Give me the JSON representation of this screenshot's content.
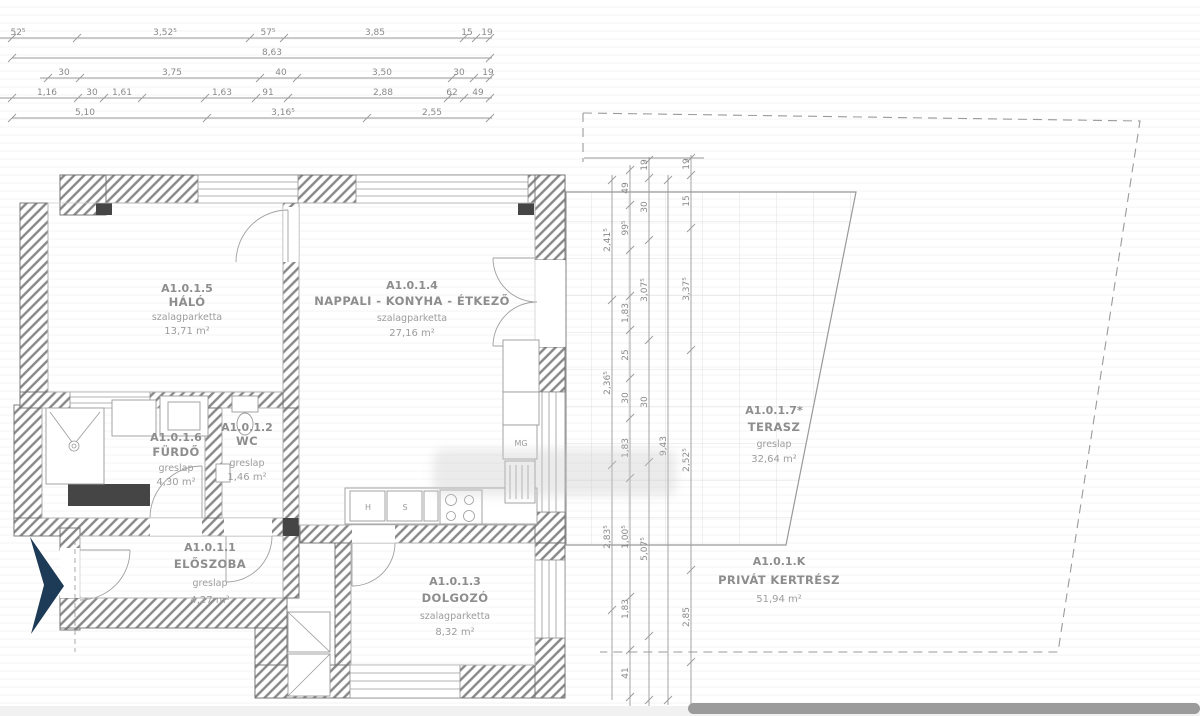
{
  "rooms": [
    {
      "id": "A1.0.1.5",
      "name": "HÁLÓ",
      "finish": "szalagparketta",
      "area": "13,71 m²"
    },
    {
      "id": "A1.0.1.4",
      "name": "NAPPALI - KONYHA - ÉTKEZŐ",
      "finish": "szalagparketta",
      "area": "27,16 m²"
    },
    {
      "id": "A1.0.1.6",
      "name": "FÜRDŐ",
      "finish": "greslap",
      "area": "4,30 m²"
    },
    {
      "id": "A1.0.1.2",
      "name": "WC",
      "finish": "greslap",
      "area": "1,46 m²"
    },
    {
      "id": "A1.0.1.1",
      "name": "ELŐSZOBA",
      "finish": "greslap",
      "area": "4,27 m²"
    },
    {
      "id": "A1.0.1.3",
      "name": "DOLGOZÓ",
      "finish": "szalagparketta",
      "area": "8,32 m²"
    },
    {
      "id": "A1.0.1.7*",
      "name": "TERASZ",
      "finish": "greslap",
      "area": "32,64 m²"
    },
    {
      "id": "A1.0.1.K",
      "name": "PRIVÁT KERTRÉSZ",
      "finish": "",
      "area": "51,94 m²"
    }
  ],
  "kitchen": {
    "h": "H",
    "s": "S",
    "mg": "MG"
  },
  "colors": {
    "arrow": "#1d3a57",
    "wall_hatch": "#878787",
    "dim_text": "#8a8a8a"
  },
  "dimensions": {
    "top_labels": [
      [
        "52⁵",
        18,
        35
      ],
      [
        "3,52⁵",
        165,
        35
      ],
      [
        "57⁵",
        268,
        35
      ],
      [
        "3,85",
        375,
        35
      ],
      [
        "15",
        467,
        35
      ],
      [
        "19",
        487,
        35
      ],
      [
        "8,63",
        272,
        55
      ],
      [
        "30",
        64,
        75
      ],
      [
        "3,75",
        172,
        75
      ],
      [
        "40",
        281,
        75
      ],
      [
        "3,50",
        382,
        75
      ],
      [
        "30",
        459,
        75
      ],
      [
        "19",
        488,
        75
      ],
      [
        "1,16",
        47,
        95
      ],
      [
        "30",
        92,
        95
      ],
      [
        "1,61",
        122,
        95
      ],
      [
        "1,63",
        222,
        95
      ],
      [
        "91",
        268,
        95
      ],
      [
        "2,88",
        383,
        95
      ],
      [
        "62",
        452,
        95
      ],
      [
        "49",
        478,
        95
      ],
      [
        "5,10",
        85,
        115
      ],
      [
        "3,16⁵",
        283,
        115
      ],
      [
        "2,55",
        432,
        115
      ]
    ],
    "top_lines": [
      [
        38,
        0,
        492
      ],
      [
        58,
        12,
        492
      ],
      [
        78,
        40,
        492
      ],
      [
        98,
        0,
        492
      ],
      [
        118,
        12,
        492
      ]
    ],
    "top_ticks": [
      [
        38,
        [
          12,
          77,
          250,
          284,
          464,
          476,
          490
        ]
      ],
      [
        58,
        [
          12,
          490
        ]
      ],
      [
        78,
        [
          48,
          80,
          260,
          297,
          452,
          474,
          490
        ]
      ],
      [
        98,
        [
          12,
          78,
          104,
          142,
          205,
          256,
          288,
          448,
          464,
          490
        ]
      ],
      [
        118,
        [
          12,
          207,
          367,
          490
        ]
      ]
    ],
    "right_labels": [
      [
        "2,41⁵",
        610,
        240
      ],
      [
        "2,36⁵",
        610,
        383
      ],
      [
        "2,83⁵",
        610,
        537
      ],
      [
        "49",
        628,
        188
      ],
      [
        "99⁵",
        628,
        228
      ],
      [
        "1,83",
        628,
        313
      ],
      [
        "25",
        628,
        355
      ],
      [
        "30",
        628,
        398
      ],
      [
        "1,83",
        628,
        448
      ],
      [
        "1,00⁵",
        628,
        537
      ],
      [
        "1,83",
        628,
        609
      ],
      [
        "41",
        628,
        673
      ],
      [
        "19",
        647,
        165
      ],
      [
        "30",
        647,
        207
      ],
      [
        "3,07⁵",
        647,
        290
      ],
      [
        "30",
        647,
        402
      ],
      [
        "5,07⁵",
        647,
        549
      ],
      [
        "9,43",
        666,
        446
      ],
      [
        "19",
        689,
        164
      ],
      [
        "15",
        689,
        201
      ],
      [
        "3,37⁵",
        689,
        289
      ],
      [
        "2,52⁵",
        689,
        460
      ],
      [
        "2,85",
        689,
        617
      ]
    ],
    "right_lines": [
      [
        612,
        175,
        700
      ],
      [
        630,
        165,
        716
      ],
      [
        649,
        157,
        716
      ],
      [
        668,
        175,
        705
      ],
      [
        691,
        155,
        716
      ]
    ],
    "right_connector": [
      584,
      158,
      704,
      158
    ],
    "right_ticks": [
      [
        612,
        [
          180,
          300,
          465,
          610
        ]
      ],
      [
        630,
        [
          170,
          205,
          250,
          296,
          330,
          378,
          418,
          478,
          597,
          650,
          697
        ]
      ],
      [
        649,
        [
          160,
          178,
          240,
          340,
          462,
          636,
          700
        ]
      ],
      [
        668,
        [
          180,
          700
        ]
      ],
      [
        691,
        [
          158,
          175,
          228,
          350,
          570,
          662
        ]
      ]
    ]
  }
}
